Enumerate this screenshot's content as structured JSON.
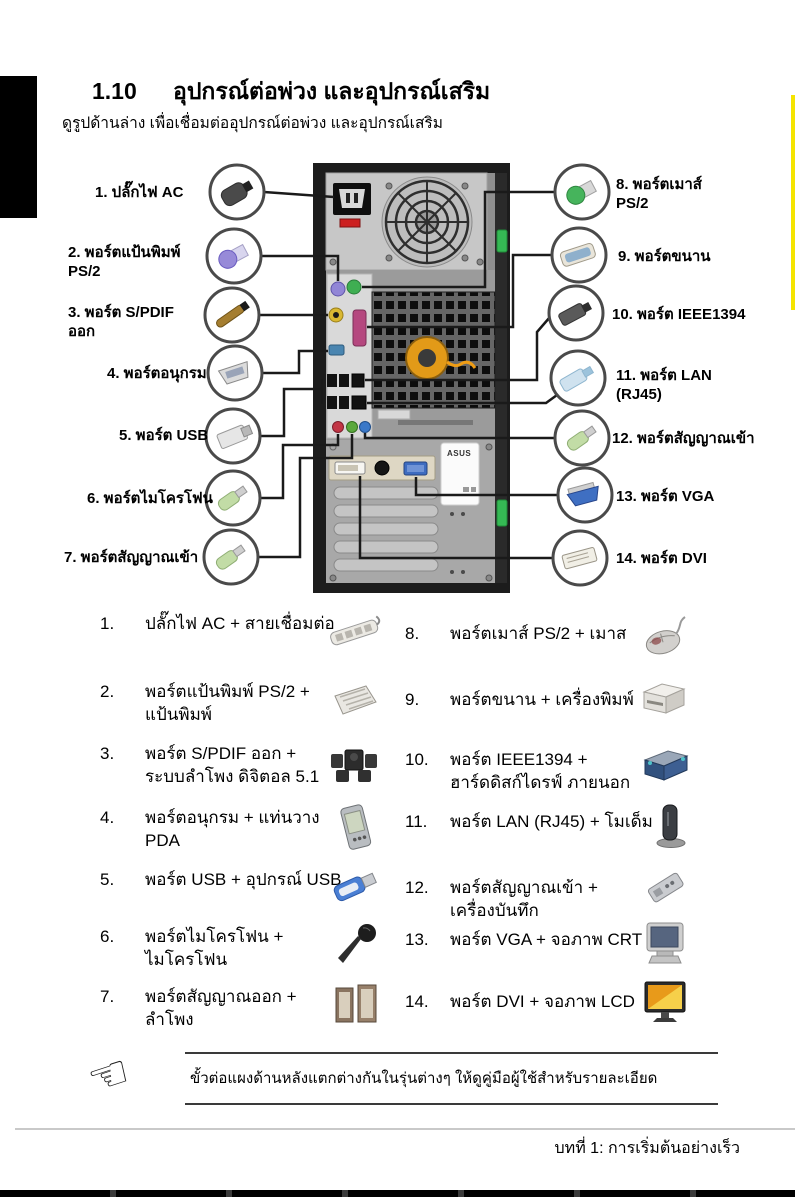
{
  "page": {
    "section_number": "1.10",
    "section_title": "อุปกรณ์ต่อพ่วง และอุปกรณ์เสริม",
    "subtitle": "ดูรูปด้านล่าง เพื่อเชื่อมต่ออุปกรณ์ต่อพ่วง และอุปกรณ์เสริม",
    "footer": "บทที่ 1: การเริ่มต้นอย่างเร็ว"
  },
  "diagram": {
    "tower_brand": "ASUS",
    "left_labels": [
      {
        "line1": "1. ปลั๊กไฟ AC",
        "line2": ""
      },
      {
        "line1": "2. พอร์ตแป้นพิมพ์",
        "line2": "PS/2"
      },
      {
        "line1": "3. พอร์ต S/PDIF",
        "line2": "ออก"
      },
      {
        "line1": "4. พอร์ตอนุกรม",
        "line2": ""
      },
      {
        "line1": "5. พอร์ต USB",
        "line2": ""
      },
      {
        "line1": "6. พอร์ตไมโครโฟน",
        "line2": ""
      },
      {
        "line1": "7. พอร์ตสัญญาณเข้า",
        "line2": ""
      }
    ],
    "right_labels": [
      {
        "line1": "8. พอร์ตเมาส์",
        "line2": "PS/2"
      },
      {
        "line1": "9. พอร์ตขนาน",
        "line2": ""
      },
      {
        "line1": "10. พอร์ต IEEE1394",
        "line2": ""
      },
      {
        "line1": "11. พอร์ต LAN",
        "line2": "(RJ45)"
      },
      {
        "line1": "12. พอร์ตสัญญาณเข้า",
        "line2": ""
      },
      {
        "line1": "13. พอร์ต VGA",
        "line2": ""
      },
      {
        "line1": "14. พอร์ต DVI",
        "line2": ""
      }
    ]
  },
  "list": {
    "left": [
      {
        "num": "1.",
        "line1": "ปลั๊กไฟ AC + สายเชื่อมต่อ",
        "line2": "",
        "icon": "power-strip"
      },
      {
        "num": "2.",
        "line1": "พอร์ตแป้นพิมพ์ PS/2 +",
        "line2": "แป้นพิมพ์",
        "icon": "keyboard"
      },
      {
        "num": "3.",
        "line1": "พอร์ต S/PDIF ออก +",
        "line2": "ระบบลำโพง ดิจิตอล 5.1",
        "icon": "speaker-system"
      },
      {
        "num": "4.",
        "line1": "พอร์ตอนุกรม + แท่นวาง",
        "line2": "PDA",
        "icon": "pda"
      },
      {
        "num": "5.",
        "line1": "พอร์ต USB + อุปกรณ์ USB",
        "line2": "",
        "icon": "usb-device"
      },
      {
        "num": "6.",
        "line1": "พอร์ตไมโครโฟน +",
        "line2": "ไมโครโฟน",
        "icon": "microphone"
      },
      {
        "num": "7.",
        "line1": "พอร์ตสัญญาณออก +",
        "line2": "ลำโพง",
        "icon": "speakers"
      }
    ],
    "right": [
      {
        "num": "8.",
        "line1": "พอร์ตเมาส์ PS/2 + เมาส",
        "line2": "",
        "icon": "mouse"
      },
      {
        "num": "9.",
        "line1": "พอร์ตขนาน + เครื่องพิมพ์",
        "line2": "",
        "icon": "printer"
      },
      {
        "num": "10.",
        "line1": "พอร์ต IEEE1394 +",
        "line2": "ฮาร์ดดิสก์ไดรฟ์ ภายนอก",
        "icon": "external-hdd"
      },
      {
        "num": "11.",
        "line1": "พอร์ต LAN (RJ45) + โมเด็ม",
        "line2": "",
        "icon": "modem"
      },
      {
        "num": "12.",
        "line1": "พอร์ตสัญญาณเข้า +",
        "line2": "เครื่องบันทึก",
        "icon": "recorder"
      },
      {
        "num": "13.",
        "line1": "พอร์ต VGA + จอภาพ CRT",
        "line2": "",
        "icon": "crt-monitor"
      },
      {
        "num": "14.",
        "line1": "พอร์ต DVI + จอภาพ LCD",
        "line2": "",
        "icon": "lcd-monitor"
      }
    ]
  },
  "note": {
    "icon_char": "☞",
    "text": "ขั้วต่อแผงด้านหลังแตกต่างกันในรุ่นต่างๆ ให้ดูคู่มือผู้ใช้สำหรับรายละเอียด"
  },
  "colors": {
    "ps2_keyboard": "#9186d6",
    "ps2_mouse": "#3fae52",
    "spdif": "#d9b832",
    "parallel_port": "#b5487f",
    "serial_port": "#4a85b0",
    "audio_mic": "#c23545",
    "audio_out": "#5aa83c",
    "audio_in": "#3a78c8",
    "vga": "#3e6cc0",
    "edge_strip": "#f5e400",
    "clip_green": "#35b954"
  }
}
